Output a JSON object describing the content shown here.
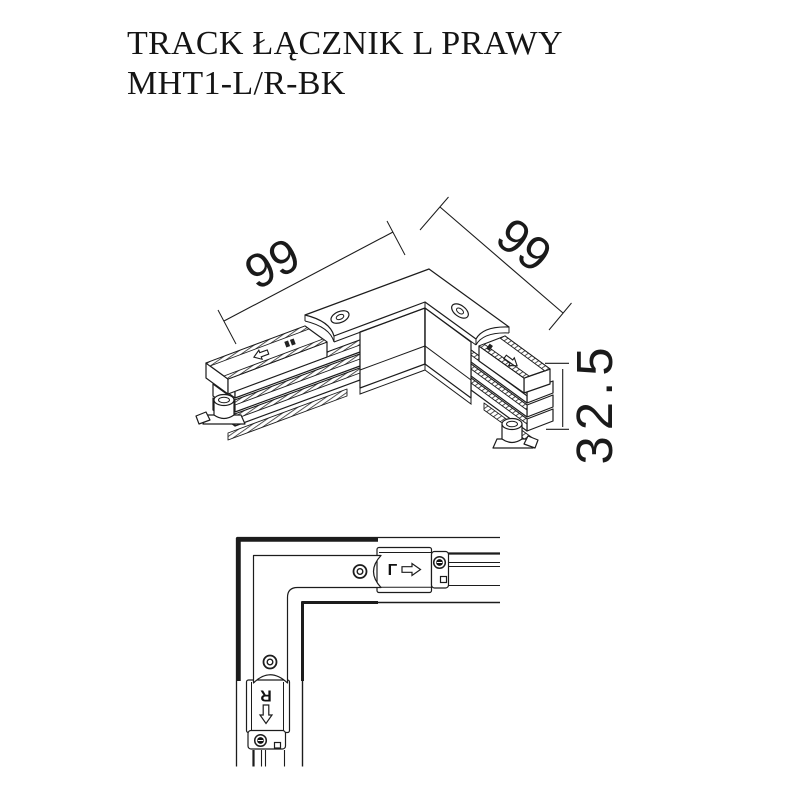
{
  "title": {
    "line1": "TRACK ŁĄCZNIK L PRAWY",
    "line2": "MHT1-L/R-BK"
  },
  "perspective_view": {
    "dim_arm_left": "99",
    "dim_arm_right": "99",
    "dim_height": "32.5"
  },
  "top_view": {
    "connector_right_letter": "L",
    "connector_bottom_letter": "R"
  },
  "colors": {
    "line": "#1c1c1c",
    "background": "#ffffff"
  }
}
